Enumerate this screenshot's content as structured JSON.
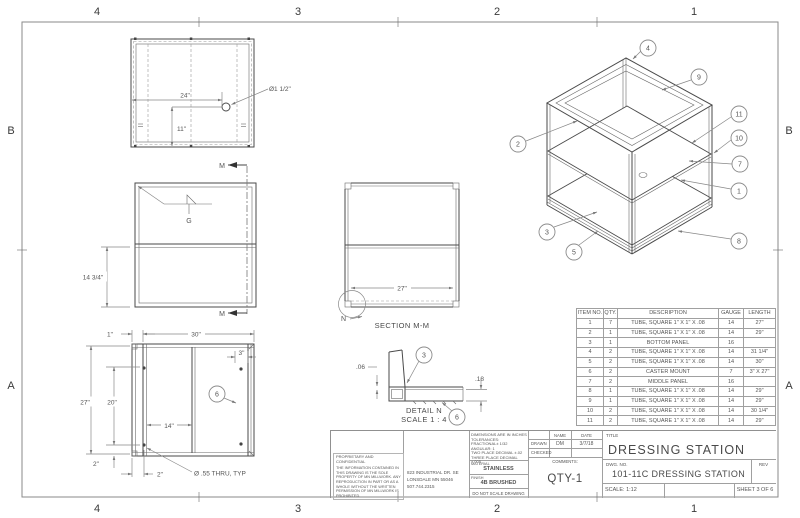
{
  "sheet": {
    "zone_cols": [
      "4",
      "3",
      "2",
      "1"
    ],
    "zone_rows": [
      "B",
      "A"
    ]
  },
  "top_view": {
    "dim_width": "24\"",
    "dim_height": "11\"",
    "hole_callout": "Ø1 1/2\""
  },
  "front_view": {
    "dim_height": "14 3/4\"",
    "section_letter_top": "M",
    "section_letter_bottom": "M",
    "weld_letter": "G"
  },
  "holes_view": {
    "dim_1": "1\"",
    "dim_30": "30\"",
    "dim_3": "3\"",
    "dim_27": "27\"",
    "dim_20": "20\"",
    "dim_14": "14\"",
    "dim_2_vert": "2\"",
    "dim_2_horiz": "2\"",
    "hole_note": "Ø .55 THRU, TYP",
    "balloon_6": "6"
  },
  "section_view": {
    "dim_27": "27\"",
    "detail_letter": "N",
    "caption": "SECTION M-M"
  },
  "detail_view": {
    "dim_06": ".06",
    "dim_18": ".18",
    "balloon_3": "3",
    "balloon_6": "6",
    "caption_line1": "DETAIL N",
    "caption_line2": "SCALE 1 : 4"
  },
  "iso_view": {
    "balloon_1": "1",
    "balloon_2": "2",
    "balloon_3": "3",
    "balloon_4": "4",
    "balloon_5": "5",
    "balloon_7": "7",
    "balloon_8": "8",
    "balloon_9": "9",
    "balloon_10": "10",
    "balloon_11": "11"
  },
  "bom": {
    "headers": {
      "item": "ITEM NO.",
      "qty": "QTY.",
      "desc": "DESCRIPTION",
      "gauge": "GAUGE",
      "length": "LENGTH"
    },
    "rows": [
      {
        "item": "1",
        "qty": "7",
        "desc": "TUBE, SQUARE 1\" X 1\" X .08",
        "gauge": "14",
        "length": "27\""
      },
      {
        "item": "2",
        "qty": "1",
        "desc": "TUBE, SQUARE 1\" X 1\" X .08",
        "gauge": "14",
        "length": "29\""
      },
      {
        "item": "3",
        "qty": "1",
        "desc": "BOTTOM PANEL",
        "gauge": "16",
        "length": ""
      },
      {
        "item": "4",
        "qty": "2",
        "desc": "TUBE, SQUARE 1\" X 1\" X .08",
        "gauge": "14",
        "length": "31 1/4\""
      },
      {
        "item": "5",
        "qty": "2",
        "desc": "TUBE, SQUARE 1\" X 1\" X .08",
        "gauge": "14",
        "length": "30\""
      },
      {
        "item": "6",
        "qty": "2",
        "desc": "CASTER MOUNT",
        "gauge": "7",
        "length": "3\" X 27\""
      },
      {
        "item": "7",
        "qty": "2",
        "desc": "MIDDLE PANEL",
        "gauge": "16",
        "length": ""
      },
      {
        "item": "8",
        "qty": "1",
        "desc": "TUBE, SQUARE 1\" X 1\" X .08",
        "gauge": "14",
        "length": "29\""
      },
      {
        "item": "9",
        "qty": "1",
        "desc": "TUBE, SQUARE 1\" X 1\" X .08",
        "gauge": "14",
        "length": "29\""
      },
      {
        "item": "10",
        "qty": "2",
        "desc": "TUBE, SQUARE 1\" X 1\" X .08",
        "gauge": "14",
        "length": "30 1/4\""
      },
      {
        "item": "11",
        "qty": "2",
        "desc": "TUBE, SQUARE 1\" X 1\" X .08",
        "gauge": "14",
        "length": "29\""
      }
    ]
  },
  "title_block": {
    "proprietary_heading": "PROPRIETARY AND CONFIDENTIAL",
    "proprietary_body": "THE INFORMATION CONTAINED IN THIS DRAWING IS THE SOLE PROPERTY OF MN MILLWORK. ANY REPRODUCTION IN PART OR AS A WHOLE WITHOUT THE WRITTEN PERMISSION OF MN MILLWORK IS PROHIBITED.",
    "address_line1": "823 INDUSTRIAL DR. SE",
    "address_line2": "LONSDALE MN 55046",
    "address_line3": "507.744.2315",
    "tol_line1": "DIMENSIONS ARE IN INCHES",
    "tol_line2": "TOLERANCES:",
    "tol_line3": "FRACTIONAL± 1/32",
    "tol_line4": "ANGULAR: 1",
    "tol_line5": "TWO PLACE DECIMAL ±.02",
    "tol_line6": "THREE PLACE DECIMAL ±.005",
    "material_label": "MATERIAL",
    "material_value": "STAINLESS",
    "finish_label": "FINISH",
    "finish_value": "4B BRUSHED",
    "no_scale": "DO NOT SCALE DRAWING",
    "name_header": "NAME",
    "date_header": "DATE",
    "drawn_label": "DRAWN",
    "drawn_name": "DM",
    "drawn_date": "3/7/18",
    "checked_label": "CHECKED",
    "comments_label": "COMMENTS:",
    "qty_note": "QTY-1",
    "title_label": "TITLE",
    "title_value": "DRESSING STATION",
    "dwg_label": "DWG. NO.",
    "dwg_value": "101-11C DRESSING STATION",
    "rev_label": "REV",
    "scale_value": "SCALE: 1:12",
    "sheet_value": "SHEET 3 OF 6"
  }
}
